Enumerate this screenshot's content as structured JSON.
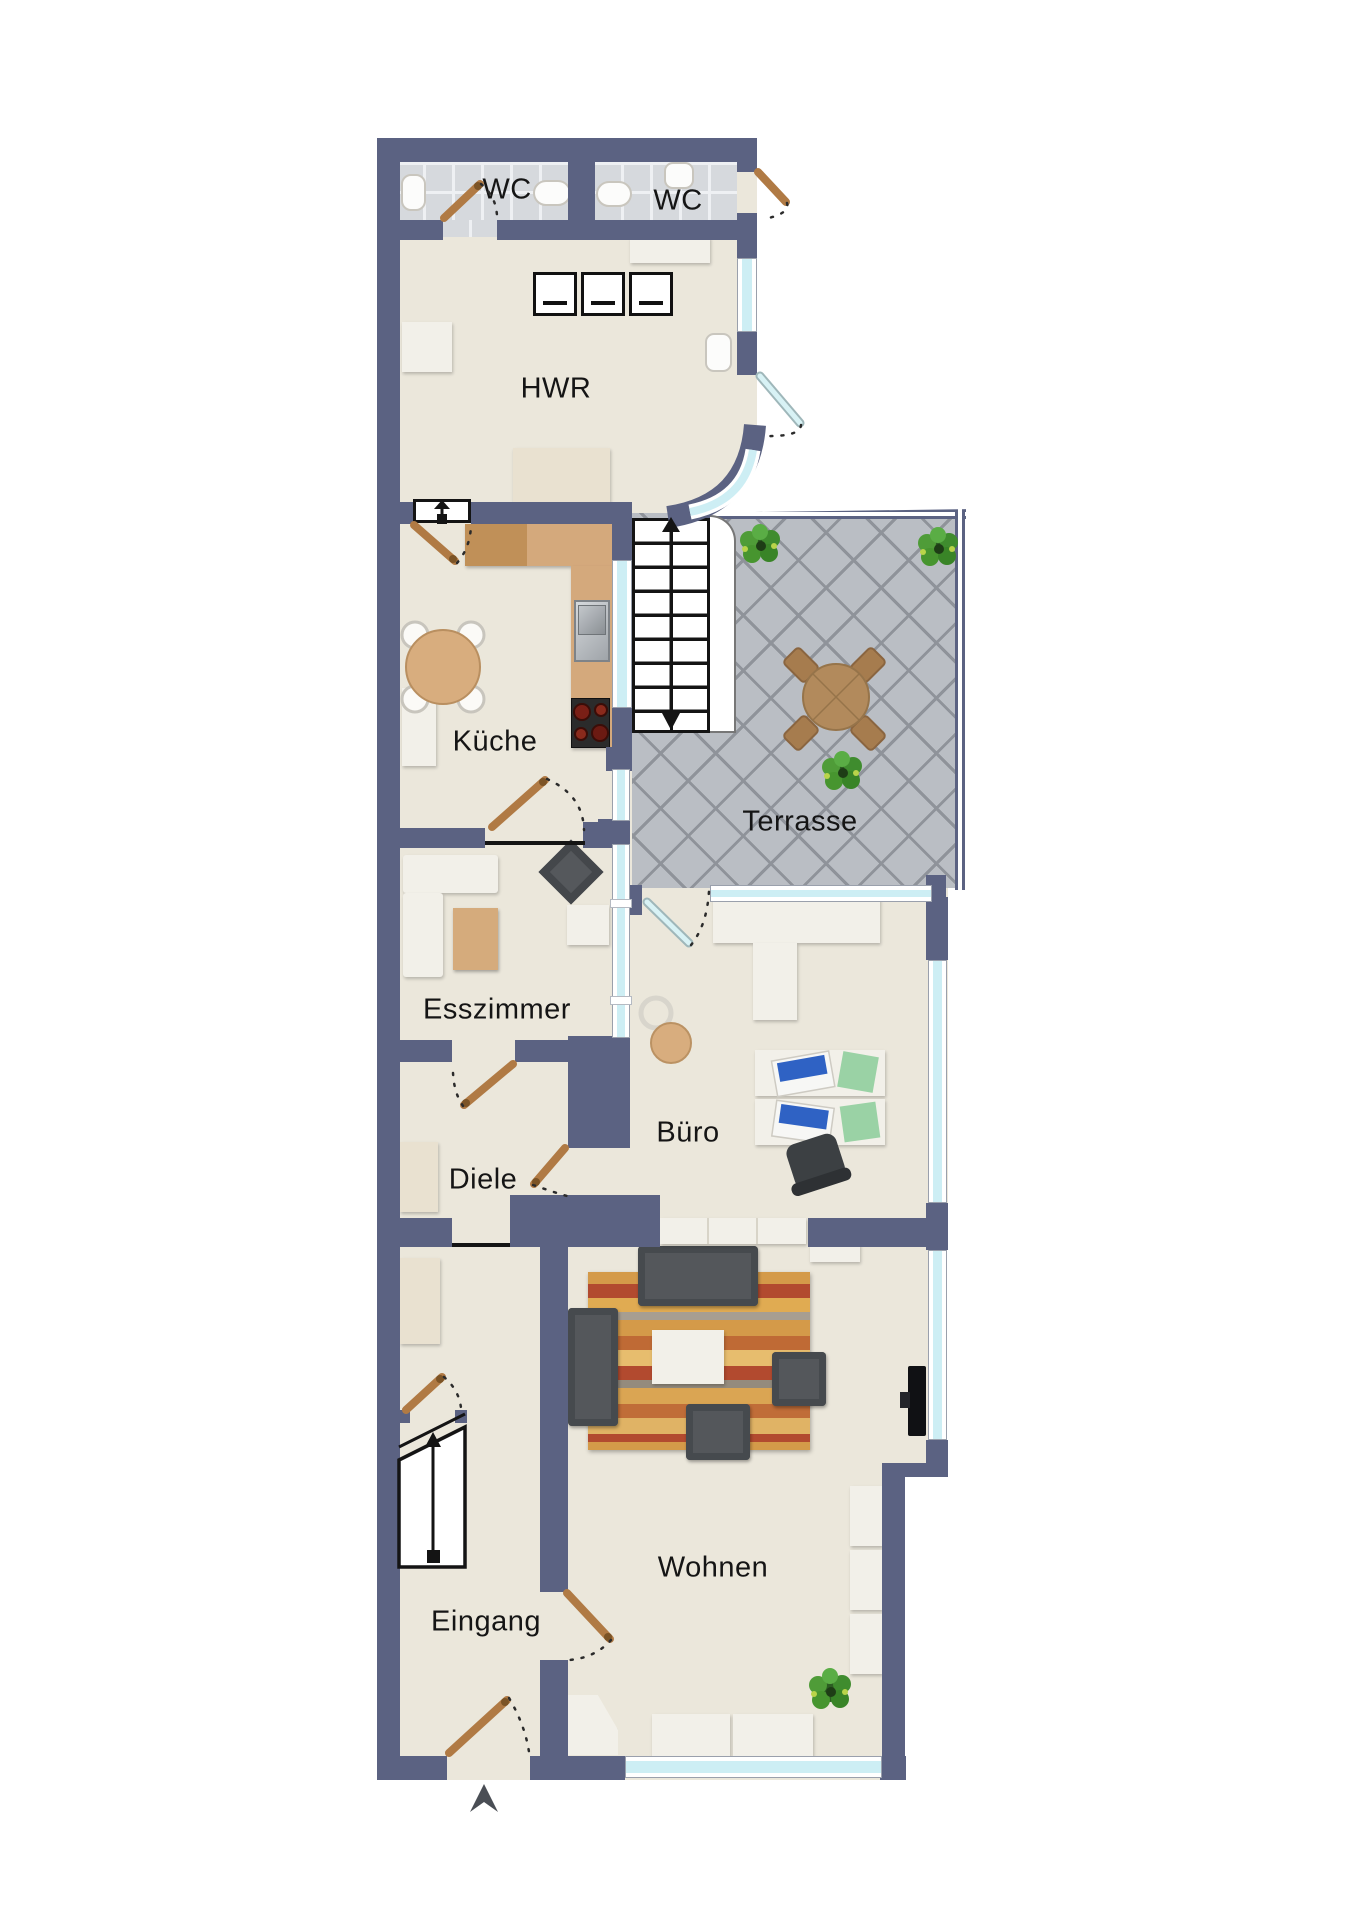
{
  "rooms": [
    {
      "id": "wc-left",
      "label": "WC"
    },
    {
      "id": "wc-right",
      "label": "WC"
    },
    {
      "id": "hwr",
      "label": "HWR"
    },
    {
      "id": "kueche",
      "label": "Küche"
    },
    {
      "id": "terrasse",
      "label": "Terrasse"
    },
    {
      "id": "esszimmer",
      "label": "Esszimmer"
    },
    {
      "id": "buero",
      "label": "Büro"
    },
    {
      "id": "diele",
      "label": "Diele"
    },
    {
      "id": "wohnen",
      "label": "Wohnen"
    },
    {
      "id": "eingang",
      "label": "Eingang"
    }
  ],
  "colors": {
    "wall": "#5b6282",
    "floor": "#ebe7db",
    "wcTile": "#d6d9dd",
    "terraceTile": "#babec4",
    "grout": "#8f939a",
    "glass": "#cdeef4",
    "frame": "#9aa0ac",
    "doorWood": "#b07a44",
    "counter": "#d4a97c",
    "counterDark": "#c09058",
    "furnWhite": "#f2f0e9",
    "sofaDark": "#54575b",
    "woodTable": "#d5ab7c",
    "officeChair": "#3c4043",
    "laptopBlue": "#2f62c4",
    "paperGreen": "#9ad2a5",
    "plantGreen": "#46992f",
    "stoveBlack": "#2b2b2b",
    "tv": "#101114",
    "entryArrow": "#4a4e55",
    "lineBlack": "#141414"
  }
}
